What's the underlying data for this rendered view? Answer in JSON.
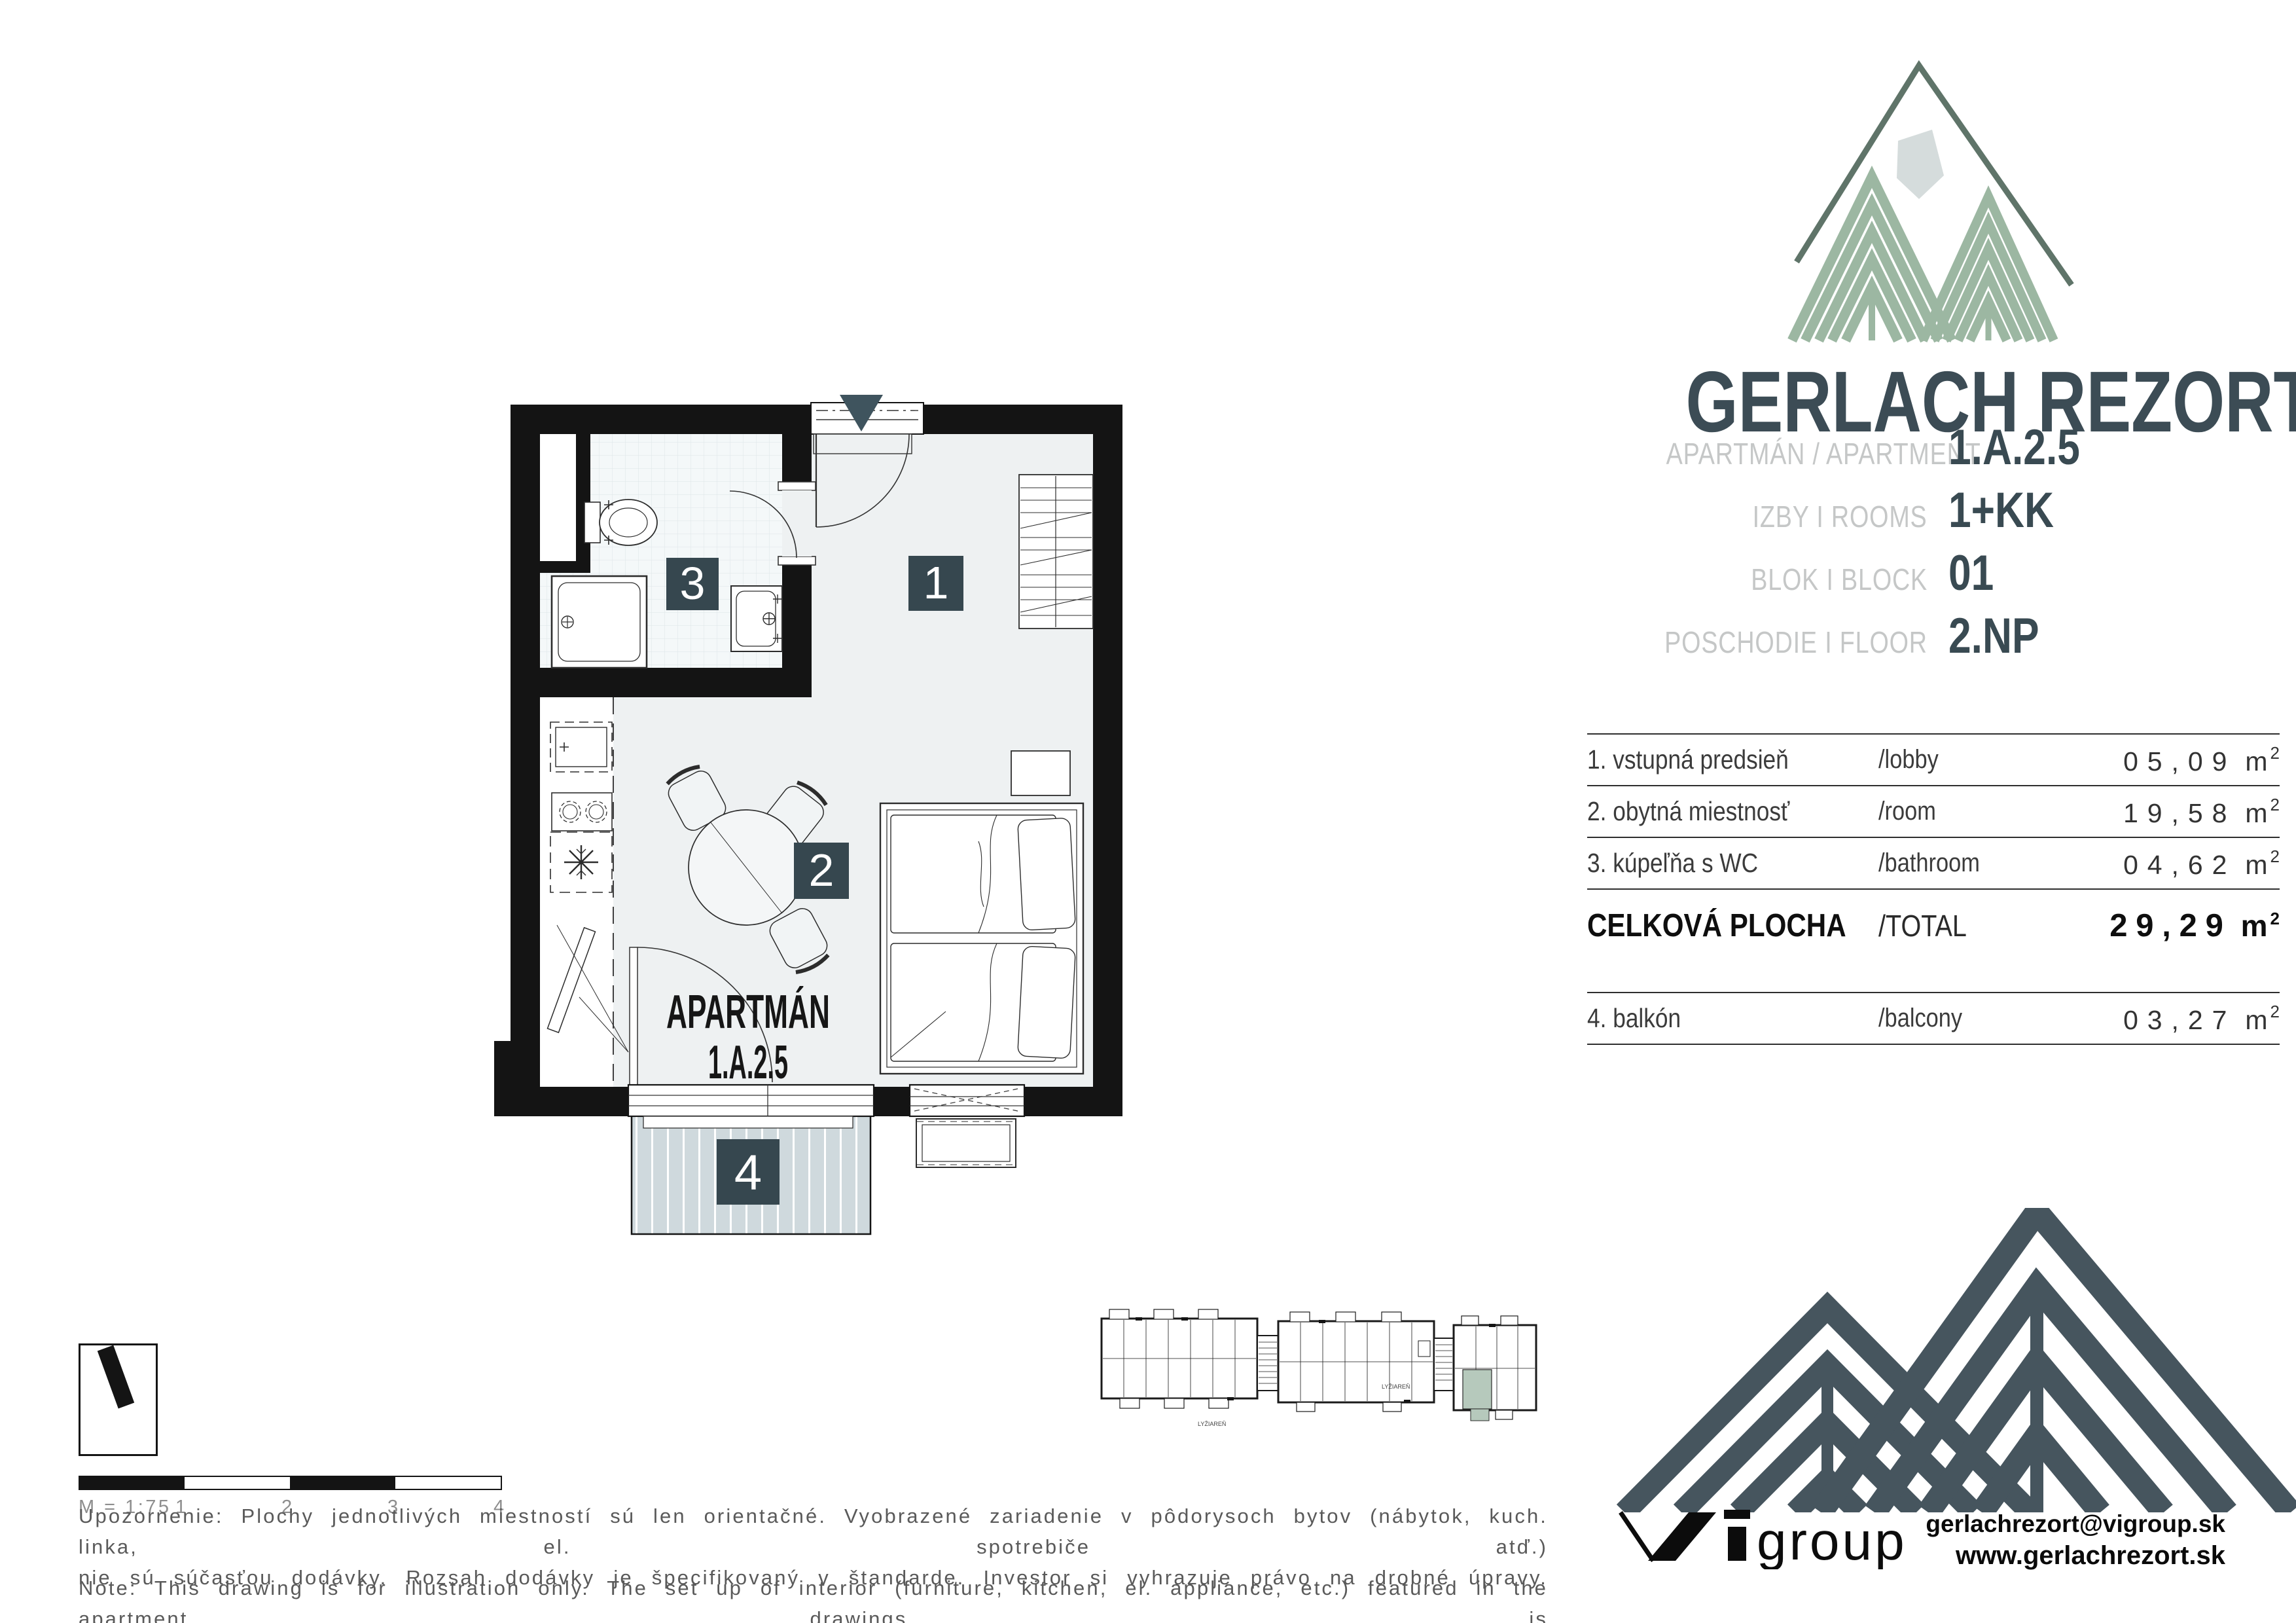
{
  "brand": {
    "wordmark": "GERLACH REZORT"
  },
  "apartment_info": {
    "rows": [
      {
        "label": "APARTMÁN / APARTMENT",
        "value": "1.A.2.5"
      },
      {
        "label": "IZBY I ROOMS",
        "value": "1+KK"
      },
      {
        "label": "BLOK I BLOCK",
        "value": "01"
      },
      {
        "label": "POSCHODIE I FLOOR",
        "value": "2.NP"
      }
    ]
  },
  "area_table": {
    "unit_base": "m",
    "unit_sup": "2",
    "rows": [
      {
        "name": "1. vstupná predsieň",
        "en": "/lobby",
        "value": "05,09"
      },
      {
        "name": "2. obytná miestnosť",
        "en": "/room",
        "value": "19,58"
      },
      {
        "name": "3. kúpeľňa s WC",
        "en": "/bathroom",
        "value": "04,62"
      }
    ],
    "total": {
      "name": "CELKOVÁ PLOCHA",
      "en": "/TOTAL",
      "value": "29,29"
    },
    "balcony": {
      "name": "4. balkón",
      "en": "/balcony",
      "value": "03,27"
    }
  },
  "plan": {
    "label_line1": "APARTMÁN",
    "label_line2": "1.A.2.5",
    "badge_1": "1",
    "badge_2": "2",
    "badge_3": "3",
    "badge_4": "4"
  },
  "minimap": {
    "label_left": "LYŽIAREŇ",
    "label_right": "LYŽIAREŇ"
  },
  "scalebar": {
    "label": "M = 1:75",
    "tick_1": "1",
    "tick_2": "2",
    "tick_3": "3",
    "tick_4": "4"
  },
  "disclaimer": {
    "sk_line1": "Upozornenie: Plochy jednotlivých miestností sú len orientačné. Vyobrazené zariadenie v pôdorysoch bytov (nábytok, kuch. linka, el. spotrebiče atď.)",
    "sk_line2": "nie sú súčasťou dodávky. Rozsah dodávky je špecifikovaný v štandarde. Investor si vyhrazuje právo na drobné úpravy.",
    "en_line1": "Note: This drawing is for illustration only. The set up of interior (furniture, kitchen, el. appliance, etc.) featured in the apartment drawings is",
    "en_line2": "not subject of delivery. The scope of delivery is specified in the standard. The investor reserves the right to implement minor changes."
  },
  "footer": {
    "logo_group": "group",
    "email": "gerlachrezort@vigroup.sk",
    "website": "www.gerlachrezort.sk"
  },
  "colors": {
    "slate": "#46555e",
    "sage": "#9cb7a2",
    "badge": "#36474f",
    "balcony_fill": "#cfd9dd",
    "wall": "#141414"
  }
}
